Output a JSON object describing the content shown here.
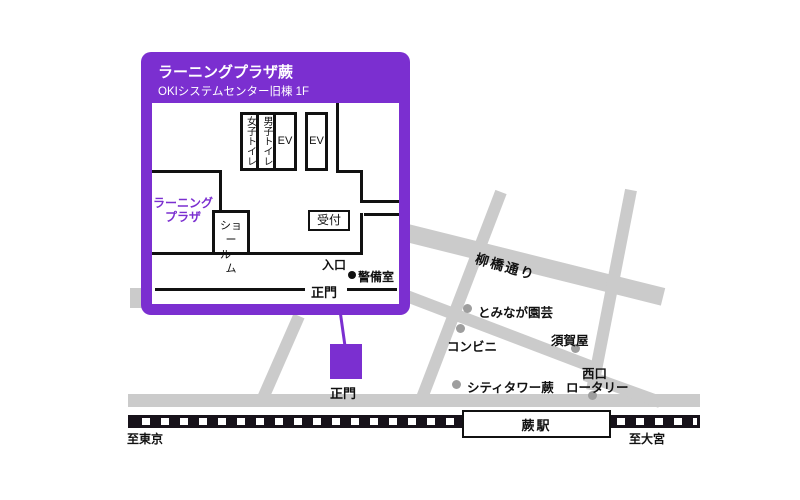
{
  "colors": {
    "accent_purple": "#7B2FD0",
    "road_gray": "#CBCBCB",
    "landmark_dot_gray": "#9E9E9E",
    "wall_black": "#111111",
    "railway_black": "#17121A"
  },
  "inset": {
    "title": "ラーニングプラザ蕨",
    "subtitle": "OKIシステムセンター旧棟 1F",
    "learning_plaza": [
      "ラーニング",
      "プラザ"
    ],
    "showroom": [
      "ショー",
      "ルーム"
    ],
    "toilet_women": "女子トイレ",
    "toilet_men": "男子トイレ",
    "elevator1": "EV",
    "elevator2": "EV",
    "reception": "受付",
    "entrance": "入口",
    "security_office": "警備室",
    "main_gate": "正門"
  },
  "map": {
    "road_name": "柳橋通り",
    "main_gate": "正門",
    "landmarks": {
      "tominaga": "とみなが園芸",
      "convenience": "コンビニ",
      "sugaya": "須賀屋",
      "city_tower": "シティタワー蕨",
      "west_rotary": [
        "西口",
        "ロータリー"
      ]
    },
    "station": "蕨駅",
    "direction_left": "至東京",
    "direction_right": "至大宮"
  }
}
